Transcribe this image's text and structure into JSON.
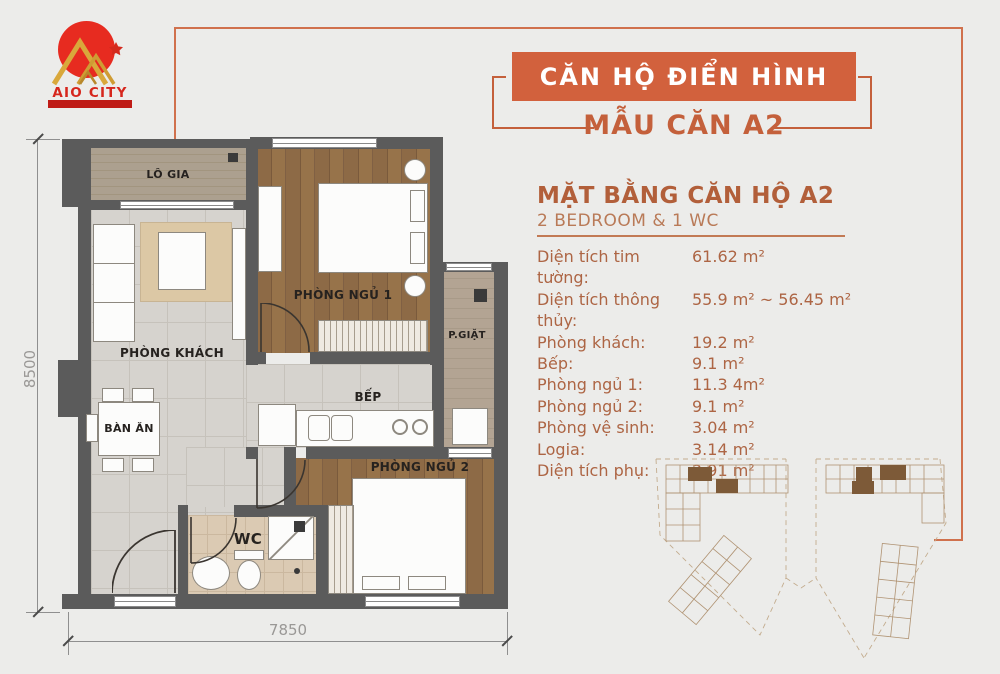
{
  "logo": {
    "name": "AIO CITY",
    "circle_color": "#e72b20",
    "gold_color": "#d9a83b",
    "bar_color": "#bf1b15"
  },
  "header": {
    "banner_label": "CĂN HỘ ĐIỂN HÌNH",
    "subtitle": "MẪU CĂN A2",
    "banner_color": "#d2613d",
    "accent_color": "#c4603b",
    "frame_color": "#d0714d"
  },
  "info": {
    "title": "MẶT BẰNG CĂN HỘ A2",
    "subtitle": "2 BEDROOM & 1 WC",
    "specs": [
      {
        "label": "Diện tích tim tường:",
        "value": "61.62 m²"
      },
      {
        "label": "Diện tích thông thủy:",
        "value": "55.9 m² ~ 56.45 m²"
      },
      {
        "label": "Phòng khách:",
        "value": "19.2 m²"
      },
      {
        "label": "Bếp:",
        "value": "9.1 m²"
      },
      {
        "label": "Phòng ngủ 1:",
        "value": "11.3 4m²"
      },
      {
        "label": "Phòng ngủ 2:",
        "value": "9.1 m²"
      },
      {
        "label": "Phòng vệ sinh:",
        "value": "3.04 m²"
      },
      {
        "label": "Logia:",
        "value": "3.14 m²"
      },
      {
        "label": "Diện tích phụ:",
        "value": "2.91 m²"
      }
    ]
  },
  "floorplan": {
    "rooms": {
      "logia": "LÔ GIA",
      "bedroom1": "PHÒNG NGỦ 1",
      "living": "PHÒNG KHÁCH",
      "laundry": "P.GIẶT",
      "kitchen": "BẾP",
      "dining": "BÀN ĂN",
      "bedroom2": "PHÒNG NGỦ 2",
      "wc": "WC"
    },
    "dimensions": {
      "width": "7850",
      "height": "8500"
    },
    "wall_color": "#5b5b5b"
  }
}
